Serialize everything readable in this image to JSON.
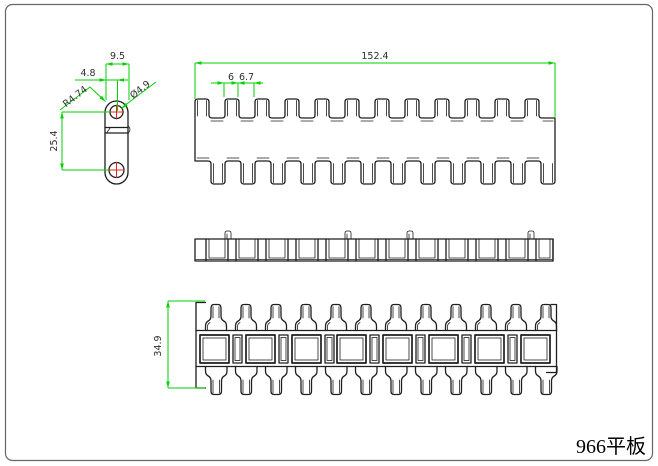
{
  "drawing": {
    "title": "966平板",
    "colors": {
      "background": "#ffffff",
      "outline": "#1e1e1e",
      "dimension": "#00d200",
      "center_mark": "#e8241a",
      "dim_text": "#2e2e2e",
      "border": "#666666",
      "title_text": "#000000"
    },
    "link_view": {
      "dim_width": "9.5",
      "dim_hole_offset": "4.8",
      "dim_radius": "R4.74",
      "dim_hole_diameter": "Ø4.9",
      "dim_hole_spacing": "25.4"
    },
    "top_view": {
      "dim_overall_length": "152.4",
      "dim_tooth_width": "6",
      "dim_tooth_gap": "6.7"
    },
    "bottom_view": {
      "dim_overall_width": "34.9"
    }
  }
}
